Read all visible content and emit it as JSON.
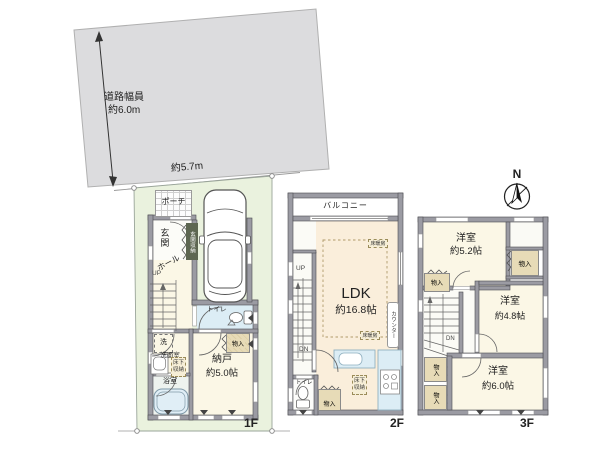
{
  "site": {
    "road_width_label": "道路幅員",
    "road_width_value": "約6.0m",
    "frontage_value": "約5.7m"
  },
  "compass": {
    "north": "N"
  },
  "floors": {
    "f1": {
      "label": "1F",
      "porch": "ポーチ",
      "entrance": "玄関",
      "entrance_storage": "玄関収納",
      "hall": "ホール",
      "up": "UP",
      "toilet": "トイレ",
      "laundry": "洗",
      "washroom": "洗面室",
      "underfloor_storage": "床下収納",
      "bathroom": "浴室",
      "storeroom": "納戸",
      "storeroom_size": "約5.0帖",
      "closet": "物入"
    },
    "f2": {
      "label": "2F",
      "balcony": "バルコニー",
      "ldk": "LDK",
      "ldk_size": "約16.8帖",
      "floor_heating": "床暖房",
      "counter": "カウンター",
      "underfloor_storage": "床下収納",
      "closet": "物入",
      "toilet": "トイレ",
      "up": "UP",
      "down": "DN"
    },
    "f3": {
      "label": "3F",
      "room1": "洋室",
      "room1_size": "約5.2帖",
      "room2": "洋室",
      "room2_size": "約4.8帖",
      "room3": "洋室",
      "room3_size": "約6.0帖",
      "closet": "物入",
      "down": "DN"
    }
  },
  "colors": {
    "road": "#dcdcde",
    "lot": "#eaf2de",
    "floor_cream": "#fbf7e6",
    "floor_peach": "#faeedb",
    "water_blue": "#dcedf5",
    "closet_tan": "#e7dbb7",
    "wall_gray": "#9b9ba3",
    "dark_label": "#5d6651"
  }
}
